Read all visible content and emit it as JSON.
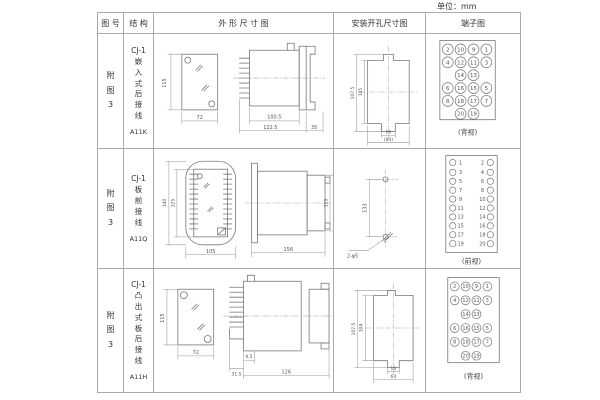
{
  "unit_label": "单位：mm",
  "table": {
    "headers": [
      "图 号",
      "结 构",
      "外 形 尺 寸 图",
      "安装开孔尺寸图",
      "端子图"
    ],
    "rows": [
      {
        "fig_no": "附\n图\n3",
        "structure": "CJ-1\n嵌\n入\n式\n后\n接\n线",
        "model": "A11K",
        "outline": {
          "h": "115",
          "w": "72",
          "l1": "100.5",
          "l2": "122.5",
          "l3": "35"
        },
        "mounting": {
          "v1": "107.5",
          "v2": "105",
          "w1": "16",
          "w2": "(64)"
        },
        "terminal": {
          "view": "(背视)",
          "r": 5.5,
          "font": 5.5,
          "cells": [
            [
              22,
              15,
              22,
              15,
              "2"
            ],
            [
              35,
              15,
              35,
              15,
              "10"
            ],
            [
              48,
              15,
              48,
              15,
              "9"
            ],
            [
              61,
              15,
              61,
              15,
              "1"
            ],
            [
              22,
              28,
              22,
              28,
              "4"
            ],
            [
              35,
              28,
              35,
              28,
              "12"
            ],
            [
              48,
              28,
              48,
              28,
              "11"
            ],
            [
              61,
              28,
              61,
              28,
              "3"
            ],
            [
              35,
              41,
              35,
              41,
              "14"
            ],
            [
              48,
              41,
              48,
              41,
              "13"
            ],
            [
              22,
              54,
              22,
              54,
              "6"
            ],
            [
              35,
              54,
              35,
              54,
              "16"
            ],
            [
              48,
              54,
              48,
              54,
              "15"
            ],
            [
              61,
              54,
              61,
              54,
              "5"
            ],
            [
              22,
              67,
              22,
              67,
              "8"
            ],
            [
              35,
              67,
              35,
              67,
              "18"
            ],
            [
              48,
              67,
              48,
              67,
              "17"
            ],
            [
              61,
              67,
              61,
              67,
              "7"
            ],
            [
              35,
              80,
              35,
              80,
              "20"
            ],
            [
              48,
              80,
              48,
              80,
              "19"
            ]
          ]
        }
      },
      {
        "fig_no": "附\n图\n3",
        "structure": "CJ-1\n板\n前\n接\n线",
        "model": "A11Q",
        "outline": {
          "h1": "140",
          "h2": "125",
          "w": "105",
          "l": "156",
          "sh": "115"
        },
        "mounting": {
          "v": "133",
          "hole": "2-φ5"
        },
        "terminal": {
          "view": "(前视)",
          "r": 3.2,
          "font": 5,
          "cells": [
            [
              27,
              13,
              35,
              13,
              "1"
            ],
            [
              65,
              13,
              57,
              13,
              "2"
            ],
            [
              27,
              23,
              35,
              23,
              "3"
            ],
            [
              65,
              23,
              57,
              23,
              "4"
            ],
            [
              27,
              32,
              35,
              32,
              "5"
            ],
            [
              65,
              32,
              57,
              32,
              "6"
            ],
            [
              27,
              41,
              35,
              41,
              "7"
            ],
            [
              65,
              41,
              57,
              41,
              "8"
            ],
            [
              27,
              50,
              35,
              50,
              "9"
            ],
            [
              65,
              50,
              57,
              50,
              "10"
            ],
            [
              27,
              59,
              35,
              59,
              "11"
            ],
            [
              65,
              59,
              57,
              59,
              "12"
            ],
            [
              27,
              68,
              35,
              68,
              "13"
            ],
            [
              65,
              68,
              57,
              68,
              "14"
            ],
            [
              27,
              77,
              35,
              77,
              "15"
            ],
            [
              65,
              77,
              57,
              77,
              "16"
            ],
            [
              27,
              86,
              35,
              86,
              "17"
            ],
            [
              65,
              86,
              57,
              86,
              "18"
            ],
            [
              27,
              95,
              35,
              95,
              "19"
            ],
            [
              65,
              95,
              57,
              95,
              "20"
            ]
          ]
        }
      },
      {
        "fig_no": "附\n图\n3",
        "structure": "CJ-1\n凸\n出\n式\n板\n后\n接\n线",
        "model": "A11H",
        "outline": {
          "h": "115",
          "w": "72",
          "d1": "31.5",
          "d2": "9.5",
          "l": "126"
        },
        "mounting": {
          "v1": "107.5",
          "v2": "104",
          "w1": "16",
          "w2": "64"
        },
        "terminal": {
          "view": "(背视)",
          "r": 4.5,
          "font": 5,
          "cells": [
            [
              29,
              17,
              29,
              17,
              "2"
            ],
            [
              40,
              17,
              40,
              17,
              "10"
            ],
            [
              51,
              17,
              51,
              17,
              "9"
            ],
            [
              62,
              17,
              62,
              17,
              "1"
            ],
            [
              29,
              31,
              29,
              31,
              "4"
            ],
            [
              40,
              31,
              40,
              31,
              "12"
            ],
            [
              51,
              31,
              51,
              31,
              "11"
            ],
            [
              62,
              31,
              62,
              31,
              "3"
            ],
            [
              40,
              45,
              40,
              45,
              "14"
            ],
            [
              51,
              45,
              51,
              45,
              "13"
            ],
            [
              29,
              59,
              29,
              59,
              "6"
            ],
            [
              40,
              59,
              40,
              59,
              "16"
            ],
            [
              51,
              59,
              51,
              59,
              "15"
            ],
            [
              62,
              59,
              62,
              59,
              "5"
            ],
            [
              29,
              73,
              29,
              73,
              "8"
            ],
            [
              40,
              73,
              40,
              73,
              "18"
            ],
            [
              51,
              73,
              51,
              73,
              "17"
            ],
            [
              62,
              73,
              62,
              73,
              "7"
            ],
            [
              40,
              87,
              40,
              87,
              "20"
            ],
            [
              51,
              87,
              51,
              87,
              "19"
            ]
          ]
        }
      }
    ]
  }
}
